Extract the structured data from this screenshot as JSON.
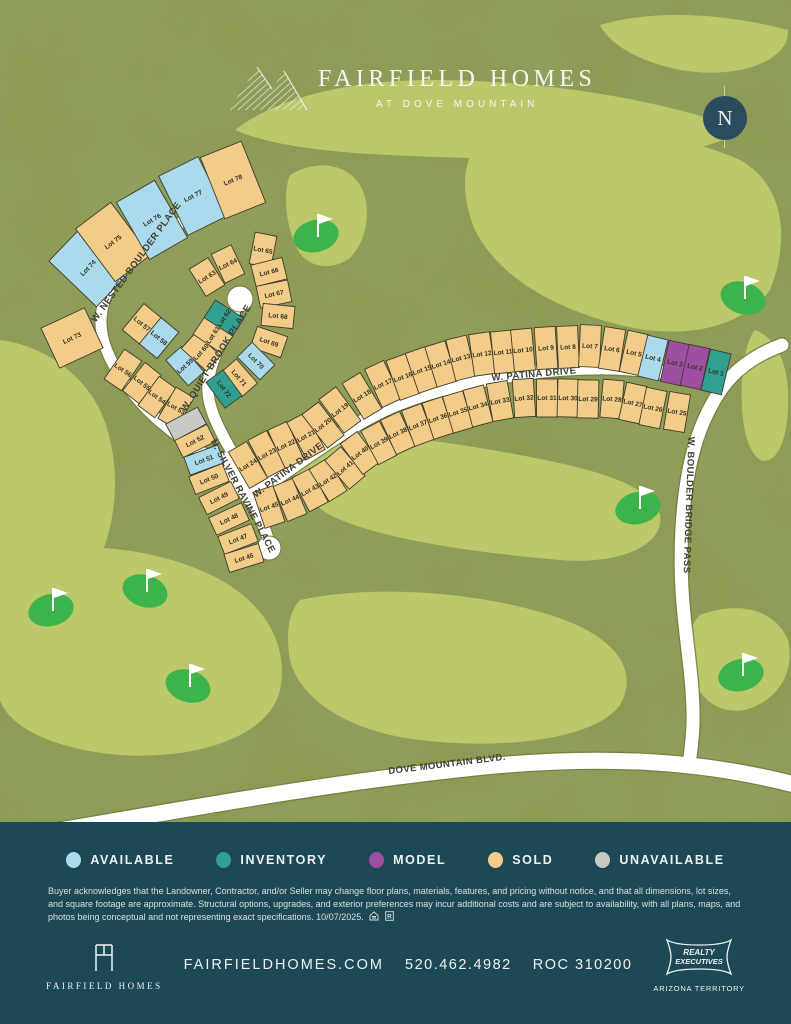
{
  "header": {
    "brand": "FAIRFIELD HOMES",
    "subbrand": "AT DOVE MOUNTAIN"
  },
  "compass_label": "N",
  "status_colors": {
    "available": "#abdaec",
    "inventory": "#31a093",
    "model": "#9d4fa1",
    "sold": "#f4cc8a",
    "unavailable": "#c9c9c5"
  },
  "legend": {
    "items": [
      {
        "key": "available",
        "label": "AVAILABLE"
      },
      {
        "key": "inventory",
        "label": "INVENTORY"
      },
      {
        "key": "model",
        "label": "MODEL"
      },
      {
        "key": "sold",
        "label": "SOLD"
      },
      {
        "key": "unavailable",
        "label": "UNAVAILABLE"
      }
    ]
  },
  "map": {
    "streets": [
      {
        "name": "W. NESTED BOULDER PLACE",
        "x": 136,
        "y": 262,
        "angle": -54
      },
      {
        "name": "W. QUIET BROOK PLACE",
        "x": 216,
        "y": 358,
        "angle": -58
      },
      {
        "name": "N. SILVER RAVINE PLACE",
        "x": 243,
        "y": 496,
        "angle": 62
      },
      {
        "name": "W. PATINA DRIVE",
        "x": 288,
        "y": 470,
        "angle": -37
      },
      {
        "name": "W. PATINA DRIVE",
        "x": 534,
        "y": 374,
        "angle": -5
      },
      {
        "name": "W. BOULDER BRIDGE PASS",
        "x": 689,
        "y": 505,
        "angle": 92
      },
      {
        "name": "DOVE MOUNTAIN BLVD.",
        "x": 447,
        "y": 764,
        "angle": -7
      }
    ],
    "golf_flags": [
      {
        "x": 318,
        "y": 228
      },
      {
        "x": 745,
        "y": 290
      },
      {
        "x": 640,
        "y": 500
      },
      {
        "x": 147,
        "y": 583
      },
      {
        "x": 53,
        "y": 602
      },
      {
        "x": 190,
        "y": 678
      },
      {
        "x": 743,
        "y": 667
      }
    ],
    "rows": [
      {
        "id": "nested-outer",
        "w": 44,
        "d": 66,
        "lots": [
          {
            "n": 74,
            "x": 88,
            "y": 268,
            "s": "available"
          },
          {
            "n": 75,
            "x": 113,
            "y": 242,
            "s": "sold"
          },
          {
            "n": 76,
            "x": 152,
            "y": 220,
            "s": "available"
          },
          {
            "n": 77,
            "x": 193,
            "y": 196,
            "s": "available"
          },
          {
            "n": 78,
            "x": 233,
            "y": 180,
            "s": "sold"
          }
        ]
      },
      {
        "id": "lot-73",
        "w": 48,
        "d": 44,
        "angle": -25,
        "lots": [
          {
            "n": 73,
            "x": 72,
            "y": 338,
            "s": "sold"
          }
        ]
      },
      {
        "id": "west-upper",
        "w": 21,
        "d": 36,
        "lots": [
          {
            "n": 56,
            "x": 123,
            "y": 370,
            "s": "sold"
          },
          {
            "n": 55,
            "x": 142,
            "y": 383,
            "s": "sold"
          },
          {
            "n": 54,
            "x": 157,
            "y": 397,
            "s": "sold"
          },
          {
            "n": 53,
            "x": 176,
            "y": 408,
            "s": "sold"
          }
        ]
      },
      {
        "id": "ravine-west",
        "w": 19,
        "d": 36,
        "lots": [
          {
            "n": null,
            "x": 186,
            "y": 424,
            "s": "unavailable"
          },
          {
            "n": 52,
            "x": 195,
            "y": 441,
            "s": "sold"
          },
          {
            "n": 51,
            "x": 204,
            "y": 460,
            "s": "available"
          },
          {
            "n": 50,
            "x": 209,
            "y": 479,
            "s": "sold"
          },
          {
            "n": 49,
            "x": 219,
            "y": 498,
            "s": "sold"
          },
          {
            "n": 48,
            "x": 229,
            "y": 519,
            "s": "sold"
          },
          {
            "n": 47,
            "x": 238,
            "y": 539,
            "s": "sold"
          },
          {
            "n": 46,
            "x": 244,
            "y": 558,
            "s": "sold"
          }
        ]
      },
      {
        "id": "row-57-58",
        "w": 23,
        "d": 34,
        "lots": [
          {
            "n": 57,
            "x": 142,
            "y": 324,
            "s": "sold"
          },
          {
            "n": 58,
            "x": 159,
            "y": 338,
            "s": "available"
          }
        ]
      },
      {
        "id": "quiet-west",
        "w": 21,
        "d": 34,
        "lots": [
          {
            "n": 59,
            "x": 185,
            "y": 366,
            "s": "available"
          },
          {
            "n": 60,
            "x": 201,
            "y": 352,
            "s": "sold"
          },
          {
            "n": 61,
            "x": 213,
            "y": 335,
            "s": "sold"
          },
          {
            "n": 62,
            "x": 224,
            "y": 318,
            "s": "inventory"
          }
        ]
      },
      {
        "id": "quiet-arc",
        "w": 22,
        "d": 32,
        "lots": [
          {
            "n": 63,
            "x": 207,
            "y": 277,
            "s": "sold"
          },
          {
            "n": 64,
            "x": 228,
            "y": 264,
            "s": "sold"
          },
          {
            "n": 65,
            "x": 263,
            "y": 250,
            "s": "sold"
          },
          {
            "n": 66,
            "x": 269,
            "y": 272,
            "s": "sold"
          },
          {
            "n": 67,
            "x": 274,
            "y": 294,
            "s": "sold"
          },
          {
            "n": 68,
            "x": 278,
            "y": 316,
            "s": "sold"
          },
          {
            "n": 69,
            "x": 269,
            "y": 342,
            "s": "sold"
          }
        ]
      },
      {
        "id": "quiet-se",
        "w": 21,
        "d": 32,
        "lots": [
          {
            "n": 70,
            "x": 256,
            "y": 361,
            "s": "available"
          },
          {
            "n": 71,
            "x": 239,
            "y": 378,
            "s": "sold"
          },
          {
            "n": 72,
            "x": 224,
            "y": 389,
            "s": "inventory"
          }
        ]
      },
      {
        "id": "patina-north",
        "w": 21,
        "d": 42,
        "lots": [
          {
            "n": 24,
            "x": 248,
            "y": 465,
            "s": "sold"
          },
          {
            "n": 23,
            "x": 267,
            "y": 454,
            "s": "sold"
          },
          {
            "n": 22,
            "x": 286,
            "y": 445,
            "s": "sold"
          },
          {
            "n": 21,
            "x": 306,
            "y": 436,
            "s": "sold"
          },
          {
            "n": 20,
            "x": 323,
            "y": 425,
            "s": "sold"
          },
          {
            "n": 19,
            "x": 340,
            "y": 410,
            "s": "sold"
          },
          {
            "n": 18,
            "x": 362,
            "y": 396,
            "s": "sold"
          },
          {
            "n": 17,
            "x": 383,
            "y": 384,
            "s": "sold"
          },
          {
            "n": 16,
            "x": 403,
            "y": 377,
            "s": "sold"
          },
          {
            "n": 15,
            "x": 422,
            "y": 370,
            "s": "sold"
          },
          {
            "n": 14,
            "x": 441,
            "y": 364,
            "s": "sold"
          },
          {
            "n": 13,
            "x": 461,
            "y": 358,
            "s": "sold"
          },
          {
            "n": 12,
            "x": 482,
            "y": 354,
            "s": "sold"
          },
          {
            "n": 11,
            "x": 503,
            "y": 352,
            "s": "sold"
          },
          {
            "n": 10,
            "x": 523,
            "y": 350,
            "s": "sold"
          },
          {
            "n": 9,
            "x": 546,
            "y": 348,
            "s": "sold"
          },
          {
            "n": 8,
            "x": 568,
            "y": 347,
            "s": "sold"
          },
          {
            "n": 7,
            "x": 590,
            "y": 346,
            "s": "sold"
          },
          {
            "n": 6,
            "x": 612,
            "y": 349,
            "s": "sold"
          },
          {
            "n": 5,
            "x": 634,
            "y": 353,
            "s": "sold"
          },
          {
            "n": 4,
            "x": 653,
            "y": 358,
            "s": "available"
          },
          {
            "n": 3,
            "x": 675,
            "y": 363,
            "s": "model"
          },
          {
            "n": 2,
            "x": 695,
            "y": 367,
            "s": "model"
          },
          {
            "n": 1,
            "x": 716,
            "y": 372,
            "s": "inventory"
          }
        ]
      },
      {
        "id": "patina-south",
        "w": 21,
        "d": 38,
        "lots": [
          {
            "n": 45,
            "x": 269,
            "y": 507,
            "s": "sold"
          },
          {
            "n": 44,
            "x": 290,
            "y": 500,
            "s": "sold"
          },
          {
            "n": 43,
            "x": 310,
            "y": 490,
            "s": "sold"
          },
          {
            "n": 42,
            "x": 328,
            "y": 480,
            "s": "sold"
          },
          {
            "n": 41,
            "x": 345,
            "y": 468,
            "s": "sold"
          },
          {
            "n": 40,
            "x": 360,
            "y": 453,
            "s": "sold"
          },
          {
            "n": 39,
            "x": 379,
            "y": 443,
            "s": "sold"
          },
          {
            "n": 38,
            "x": 398,
            "y": 433,
            "s": "sold"
          },
          {
            "n": 37,
            "x": 418,
            "y": 425,
            "s": "sold"
          },
          {
            "n": 36,
            "x": 438,
            "y": 418,
            "s": "sold"
          },
          {
            "n": 35,
            "x": 458,
            "y": 412,
            "s": "sold"
          },
          {
            "n": 34,
            "x": 478,
            "y": 406,
            "s": "sold"
          },
          {
            "n": 33,
            "x": 500,
            "y": 401,
            "s": "sold"
          },
          {
            "n": 32,
            "x": 524,
            "y": 398,
            "s": "sold"
          },
          {
            "n": 31,
            "x": 547,
            "y": 398,
            "s": "sold"
          },
          {
            "n": 30,
            "x": 568,
            "y": 398,
            "s": "sold"
          },
          {
            "n": 29,
            "x": 588,
            "y": 399,
            "s": "sold"
          },
          {
            "n": 28,
            "x": 612,
            "y": 399,
            "s": "sold"
          },
          {
            "n": 27,
            "x": 633,
            "y": 403,
            "s": "sold"
          },
          {
            "n": 26,
            "x": 653,
            "y": 408,
            "s": "sold"
          },
          {
            "n": 25,
            "x": 677,
            "y": 412,
            "s": "sold"
          }
        ]
      }
    ]
  },
  "disclaimer": {
    "text": "Buyer acknowledges that the Landowner, Contractor, and/or Seller may change floor plans, materials, features, and pricing without notice, and that all dimensions, lot sizes, and square footage are approximate. Structural options, upgrades, and exterior preferences may incur additional costs and are subject to availability, with all plans, maps, and photos being conceptual and not representing exact specifications. 10/07/2025."
  },
  "footer": {
    "brand_name": "FAIRFIELD HOMES",
    "website": "FAIRFIELDHOMES.COM",
    "phone": "520.462.4982",
    "roc": "ROC 310200",
    "badge_line1": "REALTY",
    "badge_line2": "EXECUTIVES",
    "badge_sub": "ARIZONA TERRITORY"
  }
}
